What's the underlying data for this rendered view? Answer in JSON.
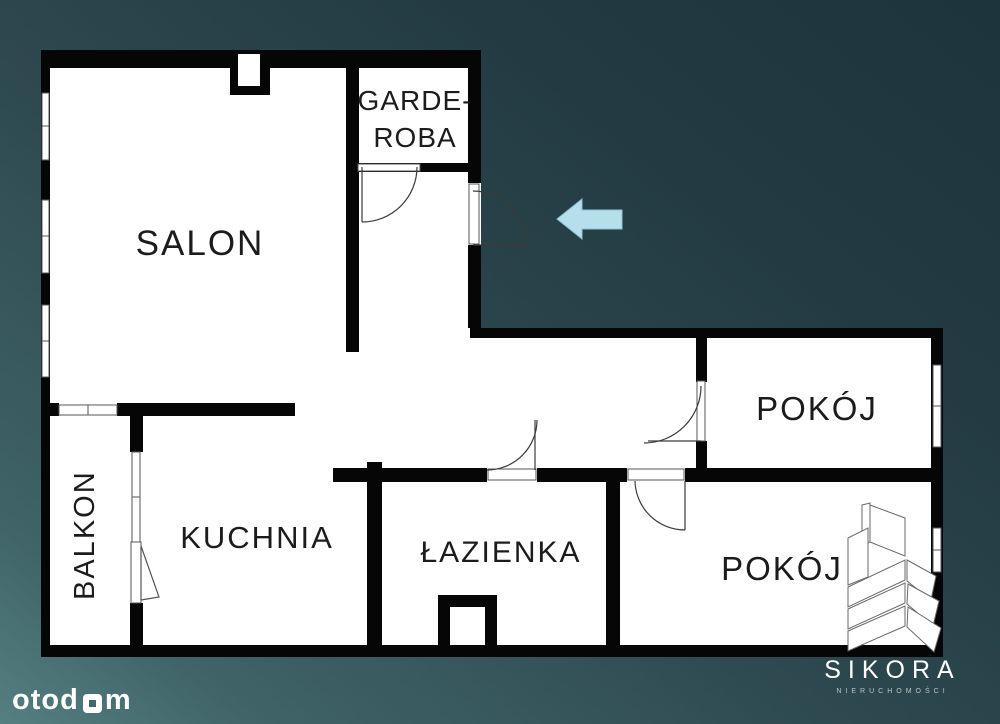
{
  "plan": {
    "type": "apartment-floor-plan",
    "wall_color": "#060606",
    "floor_color": "#ffffff",
    "background_accent": "#3f6367"
  },
  "rooms": {
    "salon": {
      "label": "SALON"
    },
    "garderoba": {
      "line1": "GARDE-",
      "line2": "ROBA"
    },
    "balkon": {
      "label": "BALKON"
    },
    "kuchnia": {
      "label": "KUCHNIA"
    },
    "lazienka": {
      "label": "ŁAZIENKA"
    },
    "pokoj_top": {
      "label": "POKÓJ"
    },
    "pokoj_bottom": {
      "label": "POKÓJ"
    }
  },
  "arrow": {
    "meaning": "entrance-direction",
    "color": "#b5dfeb"
  },
  "branding": {
    "otodom": {
      "part1": "otod",
      "part2": "m",
      "full": "otodom"
    },
    "agency": {
      "name": "SIKORA",
      "subtitle": "NIERUCHOMOŚCI"
    }
  }
}
